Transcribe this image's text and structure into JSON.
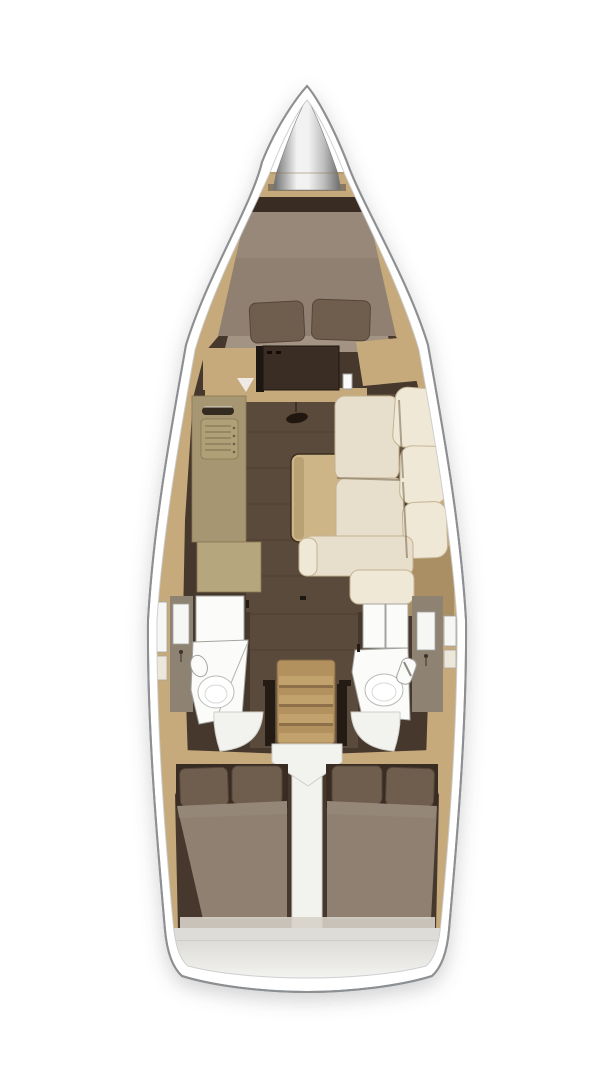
{
  "meta": {
    "description": "Top-down interior layout plan of a sailing yacht (floorplan rendering, no text labels visible)",
    "view": "overhead floor plan"
  },
  "palette": {
    "bg": "#ffffff",
    "hull_line": "#8d9093",
    "inner_line": "#c9cbcc",
    "wood": "#c6aa7b",
    "wood_dark": "#a98f63",
    "interior_dark": "#46382c",
    "interior_darker": "#392c22",
    "floor": "#5a4a3c",
    "floor_seam": "#423326",
    "mattress": "#8f8071",
    "mattress_light": "#9c8d7e",
    "mattress_foot": "#a39383",
    "pillow": "#6f5d4d",
    "pillow_edge": "#56463a",
    "cream": "#e8decc",
    "cream_hi": "#f0e8d6",
    "cream_edge": "#c2b391",
    "crevice": "#77654c",
    "table": "#cdb587",
    "table_edge": "#3a2c1f",
    "table_shadow": "#b59c6f",
    "galley": "#a79672",
    "galley_light": "#b5a67e",
    "galley_edge": "#887753",
    "door": "#3a2d23",
    "door_frame": "#1d1711",
    "white_fixture": "#fbfbf9",
    "fixture_line": "#a3a3a0",
    "vanity": "#8e8273",
    "ladder": "#b2915e",
    "ladder_step": "#c2a26c",
    "ladder_edge": "#836743",
    "rail": "#241c14",
    "engine_white": "#f2f2ef",
    "engine_edge": "#cfcfca",
    "metal_hi": "#f2f2f2",
    "metal_mid": "#bdbdbd",
    "metal_edge": "#686868",
    "stern_band": "#dddcd8",
    "stern_light": "#f6f6f4",
    "stern_shadow": "#a9a8a4",
    "hatch_white": "#f6f6f4"
  },
  "regions": {
    "hull": {
      "label": "yacht hull outline"
    },
    "anchor_locker": {
      "label": "bow anchor locker"
    },
    "forward_cabin": {
      "label": "forward cabin with V-berth"
    },
    "bulkhead_door": {
      "label": "forward cabin door"
    },
    "galley": {
      "label": "port galley with sink and stove"
    },
    "salon_table": {
      "label": "salon table"
    },
    "settee": {
      "label": "starboard L-shaped settee"
    },
    "port_head": {
      "label": "port head with toilet and shower"
    },
    "starboard_head": {
      "label": "starboard head with toilet and shower"
    },
    "companionway": {
      "label": "companionway ladder"
    },
    "engine_compartment": {
      "label": "engine compartment cover"
    },
    "aft_cabin_port": {
      "label": "port aft double cabin"
    },
    "aft_cabin_starboard": {
      "label": "starboard aft double cabin"
    },
    "stern": {
      "label": "stern transom platform"
    }
  }
}
